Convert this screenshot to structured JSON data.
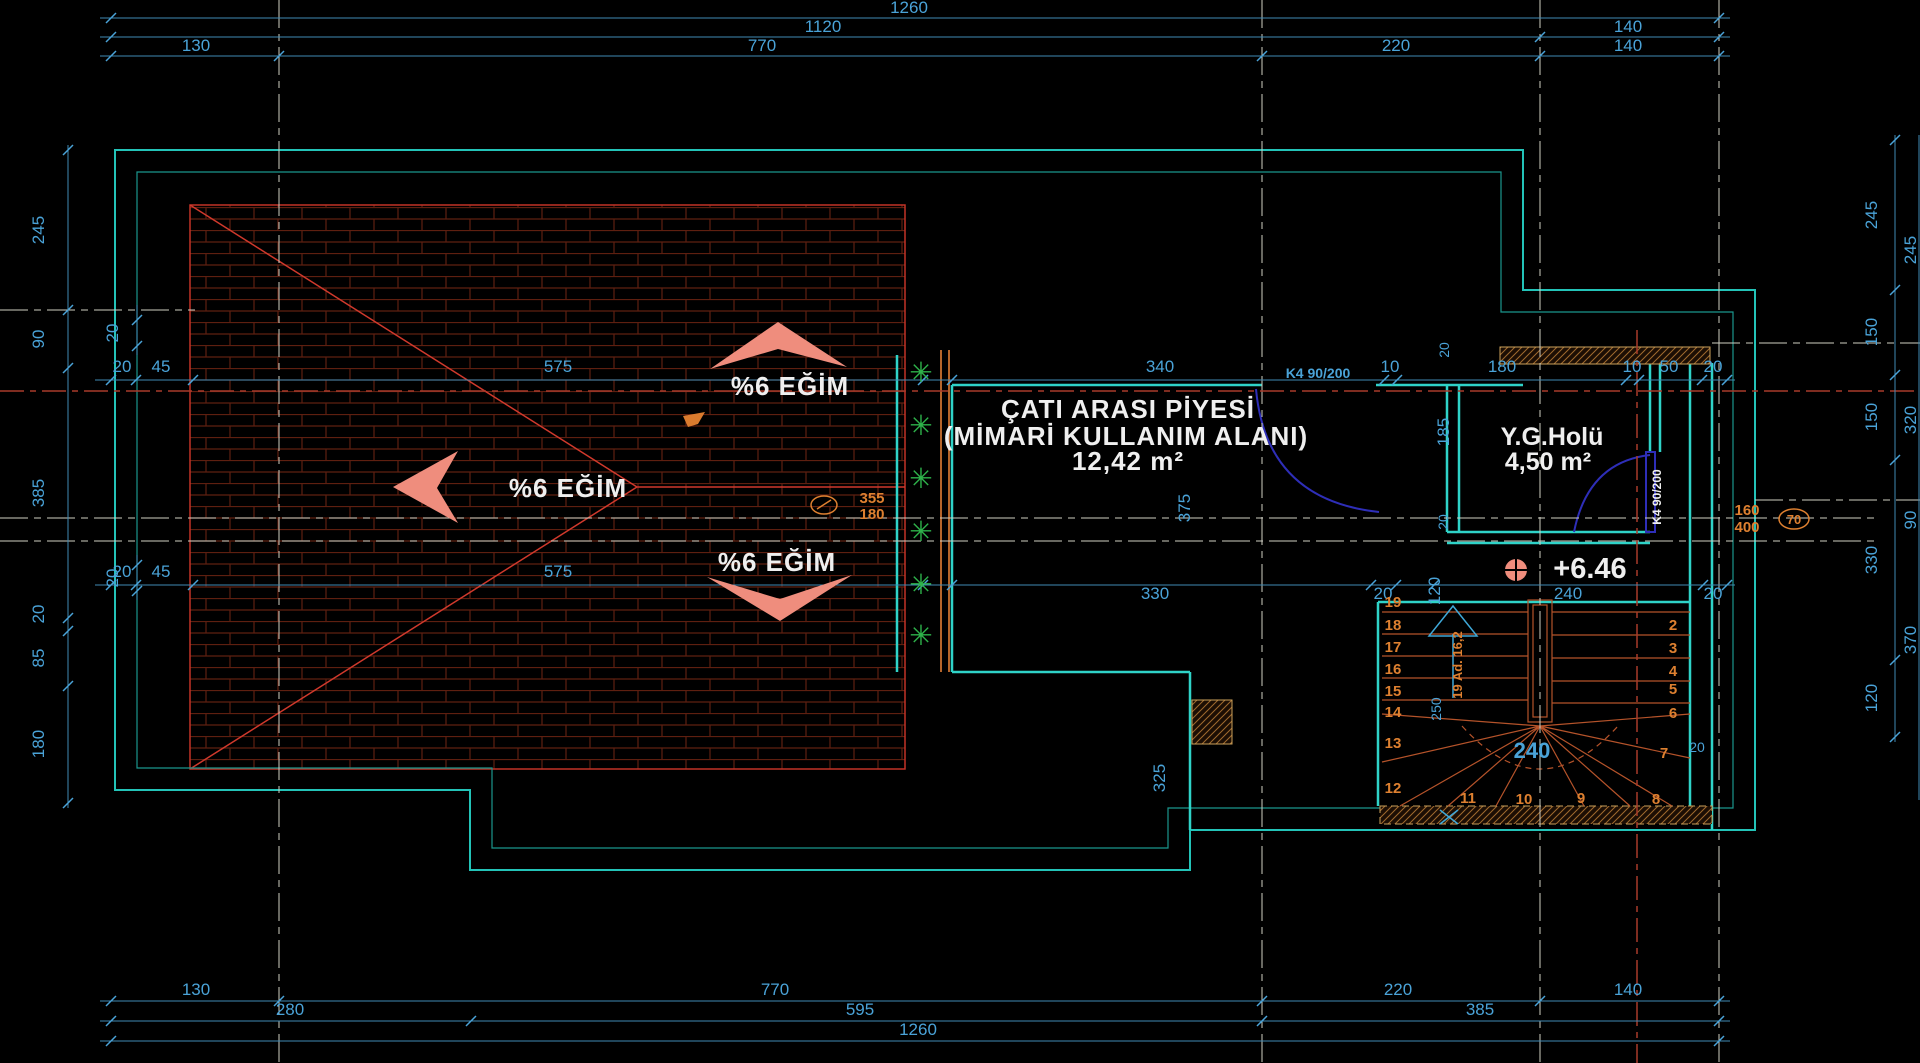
{
  "drawing": {
    "type": "architectural-roof-plan",
    "colors": {
      "background": "#000000",
      "dimension_text": "#4aa3d8",
      "dimension_line": "#3f8ab5",
      "wall_teal": "#2fd3c8",
      "outline_teal": "#23c3b8",
      "roof_red": "#c23327",
      "brick_hatch": "#5e1f10",
      "stair_orange": "#b5532a",
      "annotation_orange": "#de8030",
      "text_white": "#efefef",
      "arrow_salmon": "#ef8d7d",
      "plant_green": "#2eb24a",
      "door_blue": "#2e2eb8",
      "wall_hatch": "#a06a2e",
      "centerline_white": "#cfcfc2",
      "centerline_red": "#a83a2a"
    }
  },
  "labels": {
    "slope": "%6 EĞİM",
    "room_title": "ÇATI ARASI PİYESİ",
    "room_subtitle": "(MİMARİ KULLANIM ALANI)",
    "room_area": "12,42 m²",
    "hall_name": "Y.G.Holü",
    "hall_area": "4,50 m²",
    "level": "+6.46",
    "door_top": "K4 90/200",
    "door_side": "K4 90/200"
  },
  "dims": {
    "top1": [
      "1260"
    ],
    "top2": [
      "1120",
      "140"
    ],
    "top3": [
      "130",
      "770",
      "220",
      "140"
    ],
    "bot1": [
      "130",
      "770",
      "220",
      "140"
    ],
    "bot2": [
      "280",
      "595",
      "385"
    ],
    "bot3": [
      "1260"
    ],
    "left": [
      "245",
      "90",
      "385",
      "20",
      "85",
      "180"
    ],
    "left_inner": [
      "20",
      "20"
    ],
    "right": [
      "245",
      "150",
      "150",
      "330",
      "120"
    ],
    "edge": [
      "245",
      "320",
      "90",
      "370"
    ],
    "mid_upper": [
      "20",
      "45",
      "575",
      "340",
      "10",
      "180",
      "10",
      "50",
      "20"
    ],
    "mid_lower": [
      "20",
      "45",
      "575",
      "330",
      "20",
      "120",
      "240",
      "20"
    ],
    "misc": {
      "v375": "375",
      "v325": "325",
      "v185": "185",
      "w20a": "20",
      "w20b": "20",
      "w20c": "20"
    }
  },
  "annotations": {
    "roof_offset_top": "355",
    "roof_offset_bot": "180",
    "duct_w": "160",
    "duct_h": "400",
    "duct_d": "70",
    "stair_note": "19 Ad. 16,2",
    "stair_going": "250",
    "stair_width": "240"
  },
  "stairs": {
    "left": [
      "19",
      "18",
      "17",
      "16",
      "15",
      "14",
      "13",
      "12"
    ],
    "right": [
      "2",
      "3",
      "4",
      "5",
      "6",
      "7",
      "8"
    ],
    "bottom": [
      "11",
      "10",
      "9"
    ]
  },
  "icons": {
    "plant": "✳"
  }
}
